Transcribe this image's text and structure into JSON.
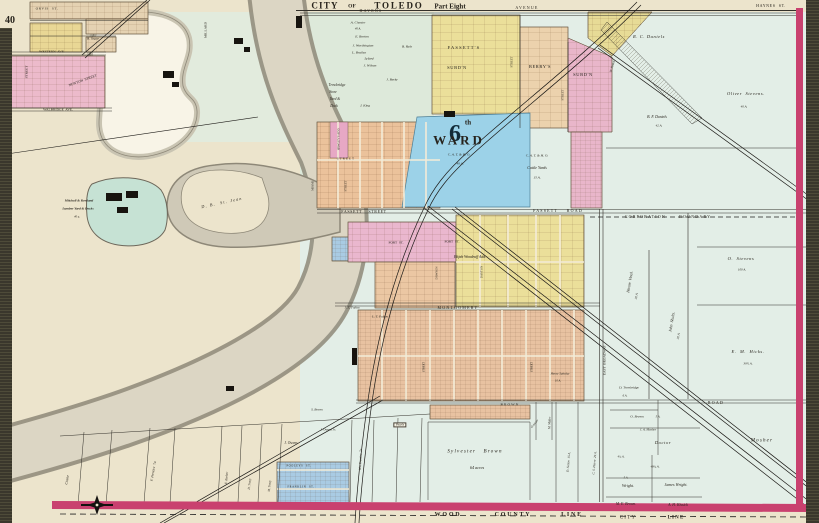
{
  "map_title": "CITY OF TOLEDO — Part Eight",
  "atlas_page": "40",
  "colors": {
    "paper": "#ece4cc",
    "farmland": "#e3eee7",
    "river_water": "#dcd6c4",
    "river_bank": "#8e8878",
    "pond_blue": "#9cd2e8",
    "mill_pond": "#c6e2d4",
    "pink_subdivision": "#e9b6ca",
    "yellow_subdivision": "#ebdf9a",
    "salmon_subdivision": "#e8c2a1",
    "peach_subdivision": "#ecd2ad",
    "blue_lots": "#a9cbe3",
    "tan_subdivision": "#e5d2b2",
    "border_magenta": "#c9416f",
    "page_edge": "#3a372c"
  },
  "labels": [
    {
      "id": "title-city",
      "t": "CITY",
      "x": 325,
      "y": 6,
      "s": 9,
      "b": 1,
      "ls": 2
    },
    {
      "id": "title-of",
      "t": "OF",
      "x": 352,
      "y": 7,
      "s": 5.5,
      "b": 1
    },
    {
      "id": "title-toledo",
      "t": "TOLEDO",
      "x": 399,
      "y": 6,
      "s": 9,
      "b": 1,
      "ls": 3
    },
    {
      "id": "title-part-eight",
      "t": "Part Eight",
      "x": 450,
      "y": 7,
      "s": 7,
      "b": 1
    },
    {
      "id": "page-number",
      "t": "40",
      "x": 10,
      "y": 21,
      "s": 10,
      "b": 1
    },
    {
      "id": "street-haynes",
      "t": "HAYNES  ST.",
      "x": 771,
      "y": 6,
      "s": 4,
      "ls": 1
    },
    {
      "id": "street-havens",
      "t": "HAVENS",
      "x": 371,
      "y": 11,
      "s": 4,
      "ls": 2
    },
    {
      "id": "street-avenue",
      "t": "AVENUE",
      "x": 527,
      "y": 8,
      "s": 4,
      "ls": 2
    },
    {
      "id": "street-orvis",
      "t": "ORVIS  ST.",
      "x": 47,
      "y": 9,
      "s": 3.5,
      "ls": 1
    },
    {
      "id": "street-western-ave",
      "t": "WESTERN  AVE.",
      "x": 52,
      "y": 52,
      "s": 3.5
    },
    {
      "id": "street-walbridge-ave",
      "t": "WALBRIDGE  AVE.",
      "x": 58,
      "y": 110,
      "s": 3.5
    },
    {
      "id": "street-newton",
      "t": "NEWTON  STREET",
      "x": 83,
      "y": 81,
      "s": 3.5,
      "r": -20
    },
    {
      "id": "street-millard",
      "t": "MILLARD",
      "x": 206,
      "y": 30,
      "s": 3.5,
      "r": -90
    },
    {
      "id": "street-left-vert",
      "t": "STREET",
      "x": 27,
      "y": 72,
      "s": 3.5,
      "r": -90
    },
    {
      "id": "street-fassett",
      "t": "FASSETT    STREET",
      "x": 364,
      "y": 212,
      "s": 4,
      "ls": 1
    },
    {
      "id": "road-fassett",
      "t": "FASSETT    ROAD",
      "x": 558,
      "y": 211,
      "s": 4,
      "ls": 2
    },
    {
      "id": "corporation-boundary",
      "t": "CORPORATION      BOUNDARY",
      "x": 668,
      "y": 217,
      "s": 4,
      "ls": 2
    },
    {
      "id": "street-fort-1",
      "t": "FORT  ST.",
      "x": 396,
      "y": 243,
      "s": 3.5
    },
    {
      "id": "street-fort-2",
      "t": "FORT  ST.",
      "x": 452,
      "y": 242,
      "s": 3.5
    },
    {
      "id": "street-montgomery",
      "t": "MONTGOMERY",
      "x": 458,
      "y": 308,
      "s": 4,
      "ls": 2
    },
    {
      "id": "street-brown",
      "t": "BROWN",
      "x": 510,
      "y": 405,
      "s": 3.5,
      "ls": 2
    },
    {
      "id": "street-east-broadway",
      "t": "EAST  BROADWAY",
      "x": 605,
      "y": 360,
      "s": 3.5,
      "r": -90
    },
    {
      "id": "road-east",
      "t": "ROAD",
      "x": 716,
      "y": 403,
      "s": 4,
      "ls": 2
    },
    {
      "id": "wood-county-wood",
      "t": "WOOD",
      "x": 448,
      "y": 515,
      "s": 6,
      "ls": 3,
      "b": 1
    },
    {
      "id": "wood-county-county",
      "t": "COUNTY",
      "x": 513,
      "y": 515,
      "s": 6,
      "ls": 3,
      "b": 1
    },
    {
      "id": "wood-county-line",
      "t": "LINE",
      "x": 572,
      "y": 515,
      "s": 6,
      "ls": 3,
      "b": 1
    },
    {
      "id": "city-line-city",
      "t": "CITY",
      "x": 628,
      "y": 518,
      "s": 5,
      "ls": 2
    },
    {
      "id": "city-line-line",
      "t": "LINE",
      "x": 676,
      "y": 518,
      "s": 5,
      "ls": 2,
      "b": 1
    },
    {
      "id": "ward-number",
      "t": "6",
      "x": 455,
      "y": 134,
      "s": 24,
      "b": 1,
      "c": "#122b38"
    },
    {
      "id": "ward-th",
      "t": "th",
      "x": 468,
      "y": 123,
      "s": 7,
      "b": 1
    },
    {
      "id": "ward-word",
      "t": "WARD",
      "x": 459,
      "y": 140,
      "s": 13,
      "b": 1,
      "ls": 5
    },
    {
      "id": "ward-railroad",
      "t": "C. A. T. & H. O.",
      "x": 459,
      "y": 155,
      "s": 3.5,
      "i": 1
    },
    {
      "id": "ward-area",
      "t": "40 A.",
      "x": 460,
      "y": 164,
      "s": 3.5,
      "i": 1
    },
    {
      "id": "cattle-railroad",
      "t": "C. A. T. & H. O.",
      "x": 537,
      "y": 156,
      "s": 3.5,
      "i": 1
    },
    {
      "id": "cattle-yards",
      "t": "Cattle Yards",
      "x": 537,
      "y": 168,
      "s": 4,
      "i": 1
    },
    {
      "id": "cattle-area",
      "t": "15 A.",
      "x": 537,
      "y": 178,
      "s": 3.5,
      "i": 1
    },
    {
      "id": "subd-fassetts-1",
      "t": "FASSETT'S",
      "x": 464,
      "y": 48,
      "s": 4.5,
      "ls": 2
    },
    {
      "id": "subd-fassetts-2",
      "t": "SUBD'N",
      "x": 457,
      "y": 68,
      "s": 4.5,
      "ls": 1
    },
    {
      "id": "subd-berrys",
      "t": "BERRY'S",
      "x": 540,
      "y": 67,
      "s": 4.5,
      "ls": 1
    },
    {
      "id": "subd-pink",
      "t": "SUBD'N",
      "x": 583,
      "y": 75,
      "s": 4.5,
      "ls": 1
    },
    {
      "id": "add-woodruff",
      "t": "Elijah Woodruff Add.",
      "x": 470,
      "y": 258,
      "s": 3.8,
      "i": 1
    },
    {
      "id": "add-hawleys",
      "t": "HAWLEY'S ADD.",
      "x": 339,
      "y": 139,
      "s": 3,
      "r": -90
    },
    {
      "id": "owner-chester",
      "t": "A. Chester",
      "x": 358,
      "y": 23,
      "s": 3.5,
      "i": 1
    },
    {
      "id": "owner-chester-area",
      "t": "40 A.",
      "x": 358,
      "y": 29,
      "s": 3,
      "i": 1
    },
    {
      "id": "owner-borton",
      "t": "E. Borton",
      "x": 362,
      "y": 37,
      "s": 3.5,
      "i": 1
    },
    {
      "id": "owner-worthington",
      "t": "J. Worthington",
      "x": 363,
      "y": 46,
      "s": 3.5,
      "i": 1
    },
    {
      "id": "owner-brailey",
      "t": "L. Brailey",
      "x": 359,
      "y": 53,
      "s": 3.5,
      "i": 1
    },
    {
      "id": "owner-lyford",
      "t": "Lyford",
      "x": 369,
      "y": 59,
      "s": 3.5,
      "i": 1
    },
    {
      "id": "owner-ryly",
      "t": "B. Ryly",
      "x": 407,
      "y": 47,
      "s": 3.5,
      "i": 1
    },
    {
      "id": "owner-wilson",
      "t": "J. Wilson",
      "x": 370,
      "y": 66,
      "s": 3.5,
      "i": 1
    },
    {
      "id": "owner-berky",
      "t": "J. Berky",
      "x": 392,
      "y": 80,
      "s": 3.5,
      "i": 1
    },
    {
      "id": "owner-king",
      "t": "J. King",
      "x": 365,
      "y": 106,
      "s": 3.5,
      "i": 1
    },
    {
      "id": "yard-trowbridge-1",
      "t": "Trowbridge",
      "x": 337,
      "y": 86,
      "s": 3.6,
      "i": 1
    },
    {
      "id": "yard-trowbridge-2",
      "t": "Store",
      "x": 333,
      "y": 93,
      "s": 3.6,
      "i": 1
    },
    {
      "id": "yard-trowbridge-3",
      "t": "Yard &",
      "x": 335,
      "y": 100,
      "s": 3.6,
      "i": 1
    },
    {
      "id": "yard-trowbridge-4",
      "t": "Dock",
      "x": 334,
      "y": 107,
      "s": 3.6,
      "i": 1
    },
    {
      "id": "owner-segur",
      "t": "B. Segur",
      "x": 93,
      "y": 39,
      "s": 3.5,
      "i": 1
    },
    {
      "id": "owner-rc-daniels",
      "t": "R. C. Daniels",
      "x": 649,
      "y": 37,
      "s": 4.5,
      "i": 1,
      "ls": 1
    },
    {
      "id": "owner-bf-daniels",
      "t": "B. F. Daniels",
      "x": 657,
      "y": 118,
      "s": 3.8,
      "i": 1
    },
    {
      "id": "owner-bf-daniels-area",
      "t": "42 A.",
      "x": 659,
      "y": 126,
      "s": 3.2,
      "i": 1
    },
    {
      "id": "owner-oliver-stevens",
      "t": "Oliver  Stevens.",
      "x": 746,
      "y": 94,
      "s": 4.5,
      "i": 1,
      "ls": 1
    },
    {
      "id": "owner-oliver-stevens-area",
      "t": "40 A.",
      "x": 744,
      "y": 107,
      "s": 3.2,
      "i": 1
    },
    {
      "id": "owner-o-stevens",
      "t": "O.  Stevens",
      "x": 741,
      "y": 259,
      "s": 4.5,
      "i": 1,
      "ls": 1
    },
    {
      "id": "owner-o-stevens-area",
      "t": "100 A.",
      "x": 742,
      "y": 270,
      "s": 3.2,
      "i": 1
    },
    {
      "id": "owner-hiram-vinal",
      "t": "Hiram  Vinal.",
      "x": 630,
      "y": 282,
      "s": 4,
      "i": 1,
      "r": -80
    },
    {
      "id": "owner-hiram-vinal-area",
      "t": "30 A.",
      "x": 637,
      "y": 296,
      "s": 3.2,
      "i": 1,
      "r": -80
    },
    {
      "id": "owner-john-shults",
      "t": "John  Shults.",
      "x": 672,
      "y": 322,
      "s": 4,
      "i": 1,
      "r": -80
    },
    {
      "id": "owner-john-shults-area",
      "t": "30 A.",
      "x": 679,
      "y": 336,
      "s": 3.2,
      "i": 1,
      "r": -80
    },
    {
      "id": "owner-em-hicks",
      "t": "E.  M.  Hicks.",
      "x": 748,
      "y": 352,
      "s": 4.5,
      "i": 1,
      "ls": 1
    },
    {
      "id": "owner-em-hicks-area",
      "t": "39½ A.",
      "x": 748,
      "y": 364,
      "s": 3.2,
      "i": 1
    },
    {
      "id": "owner-mosher",
      "t": "Mosher",
      "x": 762,
      "y": 441,
      "s": 5,
      "i": 1,
      "ls": 2
    },
    {
      "id": "owner-doctor",
      "t": "Doctor",
      "x": 663,
      "y": 443,
      "s": 4.5,
      "i": 1,
      "ls": 1
    },
    {
      "id": "owner-o-brown",
      "t": "O. Brown",
      "x": 637,
      "y": 417,
      "s": 3.5,
      "i": 1
    },
    {
      "id": "owner-o-brown-area",
      "t": "5 A.",
      "x": 658,
      "y": 417,
      "s": 3,
      "i": 1
    },
    {
      "id": "owner-ja-mosher",
      "t": "J. A. Mosher",
      "x": 648,
      "y": 430,
      "s": 3.2,
      "i": 1
    },
    {
      "id": "owner-d-trowbridge",
      "t": "D. Trowbridge",
      "x": 629,
      "y": 388,
      "s": 3.4,
      "i": 1
    },
    {
      "id": "owner-d-trowbridge-area",
      "t": "6 A.",
      "x": 625,
      "y": 396,
      "s": 3,
      "i": 1
    },
    {
      "id": "owner-wright",
      "t": "Wright.",
      "x": 628,
      "y": 486,
      "s": 4,
      "i": 1
    },
    {
      "id": "owner-wright-area",
      "t": "5 A.",
      "x": 626,
      "y": 478,
      "s": 3,
      "i": 1
    },
    {
      "id": "owner-james-wright",
      "t": "James Wright.",
      "x": 676,
      "y": 485,
      "s": 4,
      "i": 1
    },
    {
      "id": "owner-me-brown",
      "t": "M. E. Brown.",
      "x": 626,
      "y": 505,
      "s": 3.8,
      "i": 1
    },
    {
      "id": "owner-ah-kissick",
      "t": "A. H. Kissick",
      "x": 678,
      "y": 506,
      "s": 3.8,
      "i": 1
    },
    {
      "id": "area-48",
      "t": "48¾ A.",
      "x": 655,
      "y": 467,
      "s": 3.2,
      "i": 1
    },
    {
      "id": "area-4-36",
      "t": "4¾ A.",
      "x": 621,
      "y": 457,
      "s": 3,
      "i": 1
    },
    {
      "id": "owner-sylvester-brown",
      "t": "Sylvester   Brown",
      "x": 475,
      "y": 452,
      "s": 5,
      "i": 1,
      "ls": 2
    },
    {
      "id": "owner-sylvester-area",
      "t": "64 acres",
      "x": 477,
      "y": 468,
      "s": 4.2,
      "i": 1
    },
    {
      "id": "owner-sutton",
      "t": "D. Sutton  15 A.",
      "x": 569,
      "y": 462,
      "s": 3.2,
      "i": 1,
      "r": -85
    },
    {
      "id": "owner-pierre",
      "t": "C. S. Pierre  29 A.",
      "x": 595,
      "y": 463,
      "s": 3.2,
      "i": 1,
      "r": -85
    },
    {
      "id": "owner-sabelay",
      "t": "Henry Sabelay",
      "x": 560,
      "y": 374,
      "s": 3.2,
      "i": 1
    },
    {
      "id": "owner-sabelay-area",
      "t": "10 A.",
      "x": 558,
      "y": 381,
      "s": 3,
      "i": 1
    },
    {
      "id": "owner-j-owens",
      "t": "J. Owens",
      "x": 291,
      "y": 444,
      "s": 3.6,
      "i": 1
    },
    {
      "id": "owner-j-owens-jr",
      "t": "J. Owens Jr.",
      "x": 328,
      "y": 430,
      "s": 3.2,
      "i": 1
    },
    {
      "id": "owner-s-brown",
      "t": "S. Brown",
      "x": 317,
      "y": 410,
      "s": 3.2,
      "i": 1
    },
    {
      "id": "box-pearls",
      "t": "Pearls",
      "x": 400,
      "y": 425,
      "s": 3.2,
      "i": 1,
      "box": 1
    },
    {
      "id": "owner-crane",
      "t": "Crane",
      "x": 68,
      "y": 480,
      "s": 3.8,
      "i": 1,
      "r": -80
    },
    {
      "id": "owner-f-prentice",
      "t": "F. Prentice  7a.",
      "x": 154,
      "y": 471,
      "s": 3.4,
      "i": 1,
      "r": -80
    },
    {
      "id": "owner-e-barber",
      "t": "E. Barber",
      "x": 227,
      "y": 478,
      "s": 3.2,
      "i": 1,
      "r": -85
    },
    {
      "id": "owner-d-tracy",
      "t": "D. Tracy",
      "x": 250,
      "y": 484,
      "s": 3.2,
      "i": 1,
      "r": -85
    },
    {
      "id": "owner-m-tracy",
      "t": "M. Tracy",
      "x": 270,
      "y": 486,
      "s": 3.2,
      "i": 1,
      "r": -85
    },
    {
      "id": "owner-wm-prentice",
      "t": "Wm Prentice  7a.",
      "x": 361,
      "y": 459,
      "s": 3.2,
      "i": 1,
      "r": -87
    },
    {
      "id": "street-pooleys",
      "t": "POOLEYS  ST.",
      "x": 299,
      "y": 467,
      "s": 2.8,
      "ls": 1
    },
    {
      "id": "street-franklin",
      "t": "FRANKLIN  ST.",
      "x": 301,
      "y": 488,
      "s": 2.8,
      "ls": 1
    },
    {
      "id": "owner-st-jean",
      "t": "D. B.  St. Jean",
      "x": 222,
      "y": 203,
      "s": 4.2,
      "i": 1,
      "r": -12,
      "ls": 2
    },
    {
      "id": "yard-mitchell-1",
      "t": "Mitchell & Rowland",
      "x": 79,
      "y": 201,
      "s": 3.4,
      "i": 1,
      "b": 1
    },
    {
      "id": "yard-mitchell-2",
      "t": "Lumber Yard & Docks",
      "x": 78,
      "y": 209,
      "s": 3.4,
      "i": 1,
      "b": 1
    },
    {
      "id": "yard-mitchell-3",
      "t": "40 a.",
      "x": 77,
      "y": 217,
      "s": 3,
      "i": 1
    },
    {
      "id": "street-miami",
      "t": "MIAMI",
      "x": 313,
      "y": 186,
      "s": 3,
      "r": -90
    },
    {
      "id": "street-vert-1",
      "t": "STREET",
      "x": 346,
      "y": 186,
      "s": 3,
      "r": -90
    },
    {
      "id": "street-center",
      "t": "STREET",
      "x": 346,
      "y": 159,
      "s": 3,
      "ls": 2
    },
    {
      "id": "street-dawson",
      "t": "DAWSON",
      "x": 437,
      "y": 273,
      "s": 3,
      "r": -90
    },
    {
      "id": "street-dayton",
      "t": "DAYTON",
      "x": 482,
      "y": 272,
      "s": 3,
      "r": -90
    },
    {
      "id": "street-vert-2",
      "t": "STREET",
      "x": 512,
      "y": 62,
      "s": 3,
      "r": -90
    },
    {
      "id": "street-vert-3",
      "t": "STREET",
      "x": 563,
      "y": 95,
      "s": 3,
      "r": -90
    },
    {
      "id": "owner-fearns",
      "t": "W. Fearns",
      "x": 613,
      "y": 66,
      "s": 3.2,
      "i": 1,
      "r": -72
    },
    {
      "id": "owner-grasser",
      "t": "Grasser",
      "x": 535,
      "y": 424,
      "s": 3.2,
      "i": 1,
      "r": -50
    },
    {
      "id": "owner-m-miller",
      "t": "M. Miller",
      "x": 550,
      "y": 423,
      "s": 3.2,
      "i": 1,
      "r": -87
    },
    {
      "id": "street-vert-4",
      "t": "STREET",
      "x": 425,
      "y": 367,
      "s": 2.8,
      "r": -90
    },
    {
      "id": "street-vert-5",
      "t": "STREET",
      "x": 533,
      "y": 367,
      "s": 2.8,
      "r": -90
    },
    {
      "id": "owner-lt-fulton",
      "t": "L. T. Fulton",
      "x": 380,
      "y": 317,
      "s": 3.4,
      "i": 1
    },
    {
      "id": "owner-je-fulton",
      "t": "J. E. Fulton",
      "x": 352,
      "y": 308,
      "s": 3.2,
      "i": 1
    }
  ]
}
